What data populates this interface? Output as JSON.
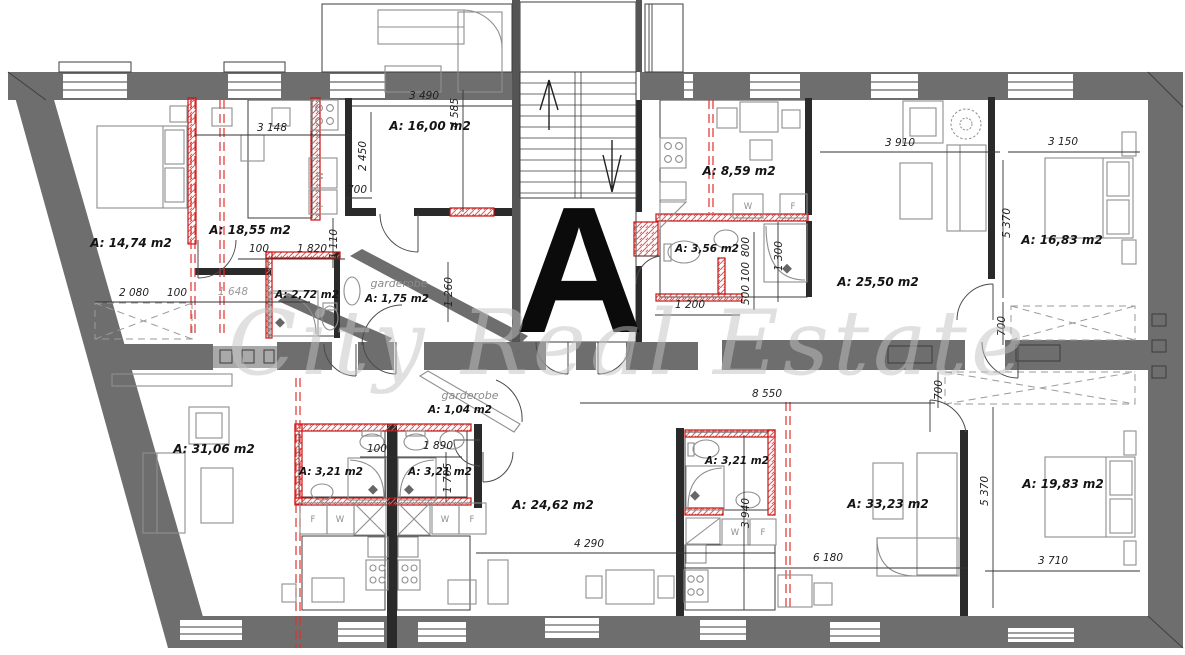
{
  "marker": "A",
  "watermark": "City Real Estate",
  "colors": {
    "wall": "#6e6e6e",
    "accent_red": "#cc2222",
    "tile": "#cfcfcf"
  },
  "rooms": [
    {
      "name": "bedroom-top-left",
      "area": "A: 14,74 m2"
    },
    {
      "name": "kitchen-top-left",
      "area": "A: 18,55 m2"
    },
    {
      "name": "bath-top-left",
      "area": "A: 2,72 m2"
    },
    {
      "name": "living-top-middle",
      "area": "A: 16,00 m2"
    },
    {
      "name": "kitchen-top-right",
      "area": "A: 8,59 m2"
    },
    {
      "name": "bath-top-right",
      "area": "A: 3,56 m2"
    },
    {
      "name": "living-top-right",
      "area": "A: 25,50 m2"
    },
    {
      "name": "bedroom-right",
      "area": "A: 16,83 m2"
    },
    {
      "name": "living-bottom-left",
      "area": "A: 31,06 m2"
    },
    {
      "name": "bath-bottom-left",
      "area": "A: 3,21 m2"
    },
    {
      "name": "bath-bottom-middle",
      "area": "A: 3,21 m2"
    },
    {
      "name": "living-bottom-middle",
      "area": "A: 24,62 m2"
    },
    {
      "name": "bath-bottom-right",
      "area": "A: 3,21 m2"
    },
    {
      "name": "living-bottom-right",
      "area": "A: 33,23 m2"
    },
    {
      "name": "bedroom-bottom-right",
      "area": "A: 19,83 m2"
    }
  ],
  "closets": [
    {
      "label": "garderobe",
      "area": "A: 1,75 m2"
    },
    {
      "label": "garderobe",
      "area": "A: 1,04 m2"
    }
  ],
  "appliances": {
    "washer": "W",
    "fridge": "F"
  },
  "dims": {
    "h": [
      "3 148",
      "3 490",
      "700",
      "100",
      "1 820",
      "2 080",
      "100",
      "1 648",
      "3 910",
      "3 150",
      "1 200",
      "8 550",
      "100",
      "1 890",
      "4 290",
      "6 180",
      "3 710"
    ],
    "v": [
      "2 450",
      "4 585",
      "1 110",
      "1 260",
      "800",
      "100",
      "500",
      "1 300",
      "5 370",
      "700",
      "700",
      "1 705",
      "3 940",
      "5 370"
    ]
  }
}
